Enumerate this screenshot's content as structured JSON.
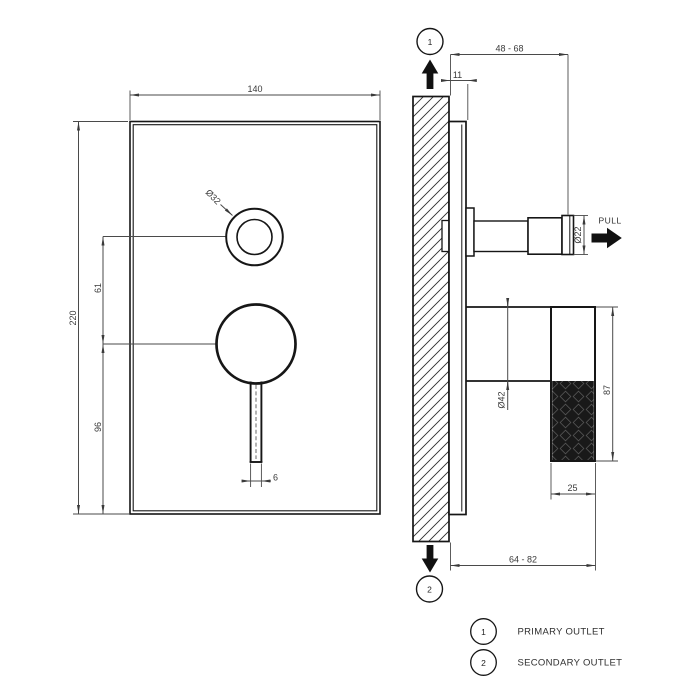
{
  "front_view": {
    "dim_plate_width": "140",
    "dim_plate_height": "220",
    "dim_knob_to_lever": "61",
    "dim_lever_to_bottom": "96",
    "dim_lever_width": "6",
    "label_knob_diameter": "Ø32"
  },
  "side_view": {
    "dim_depth_range": "48 - 68",
    "dim_plate_thickness": "11",
    "label_knob_diameter": "Ø22",
    "pull_label": "PULL",
    "label_body_diameter": "Ø42",
    "dim_handle_length": "87",
    "dim_handle_depth": "25",
    "dim_total_depth_range": "64 - 82"
  },
  "callouts": {
    "top_number": "1",
    "bottom_number": "2"
  },
  "legend": {
    "item1_number": "1",
    "item1_label": "PRIMARY OUTLET",
    "item2_number": "2",
    "item2_label": "SECONDARY OUTLET"
  },
  "colors": {
    "object_line": "#161616",
    "dimension_line": "#4a4a4a",
    "fill": "#ffffff",
    "knurl": "#191919"
  }
}
